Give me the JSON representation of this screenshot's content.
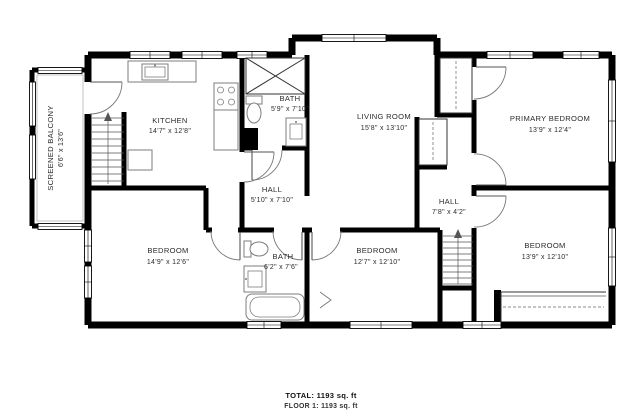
{
  "floorplan": {
    "rooms": [
      {
        "name": "SCREENED BALCONY",
        "dims": "6'6\" x 13'6\""
      },
      {
        "name": "KITCHEN",
        "dims": "14'7\" x 12'8\""
      },
      {
        "name": "BATH",
        "dims": "5'9\" x 7'10\""
      },
      {
        "name": "LIVING ROOM",
        "dims": "15'8\" x 13'10\""
      },
      {
        "name": "PRIMARY BEDROOM",
        "dims": "13'9\" x 12'4\""
      },
      {
        "name": "HALL",
        "dims": "5'10\" x 7'10\""
      },
      {
        "name": "HALL",
        "dims": "7'8\" x 4'2\""
      },
      {
        "name": "BEDROOM",
        "dims": "14'9\" x 12'6\""
      },
      {
        "name": "BATH",
        "dims": "6'2\" x 7'6\""
      },
      {
        "name": "BEDROOM",
        "dims": "12'7\" x 12'10\""
      },
      {
        "name": "BEDROOM",
        "dims": "13'9\" x 12'10\""
      }
    ],
    "summary": {
      "total": "TOTAL: 1193 sq. ft",
      "floor1": "FLOOR 1: 1193 sq. ft"
    },
    "colors": {
      "wall": "#000000",
      "background": "#ffffff",
      "fixture": "#7d7d7d",
      "text": "#2b2b2b"
    }
  }
}
